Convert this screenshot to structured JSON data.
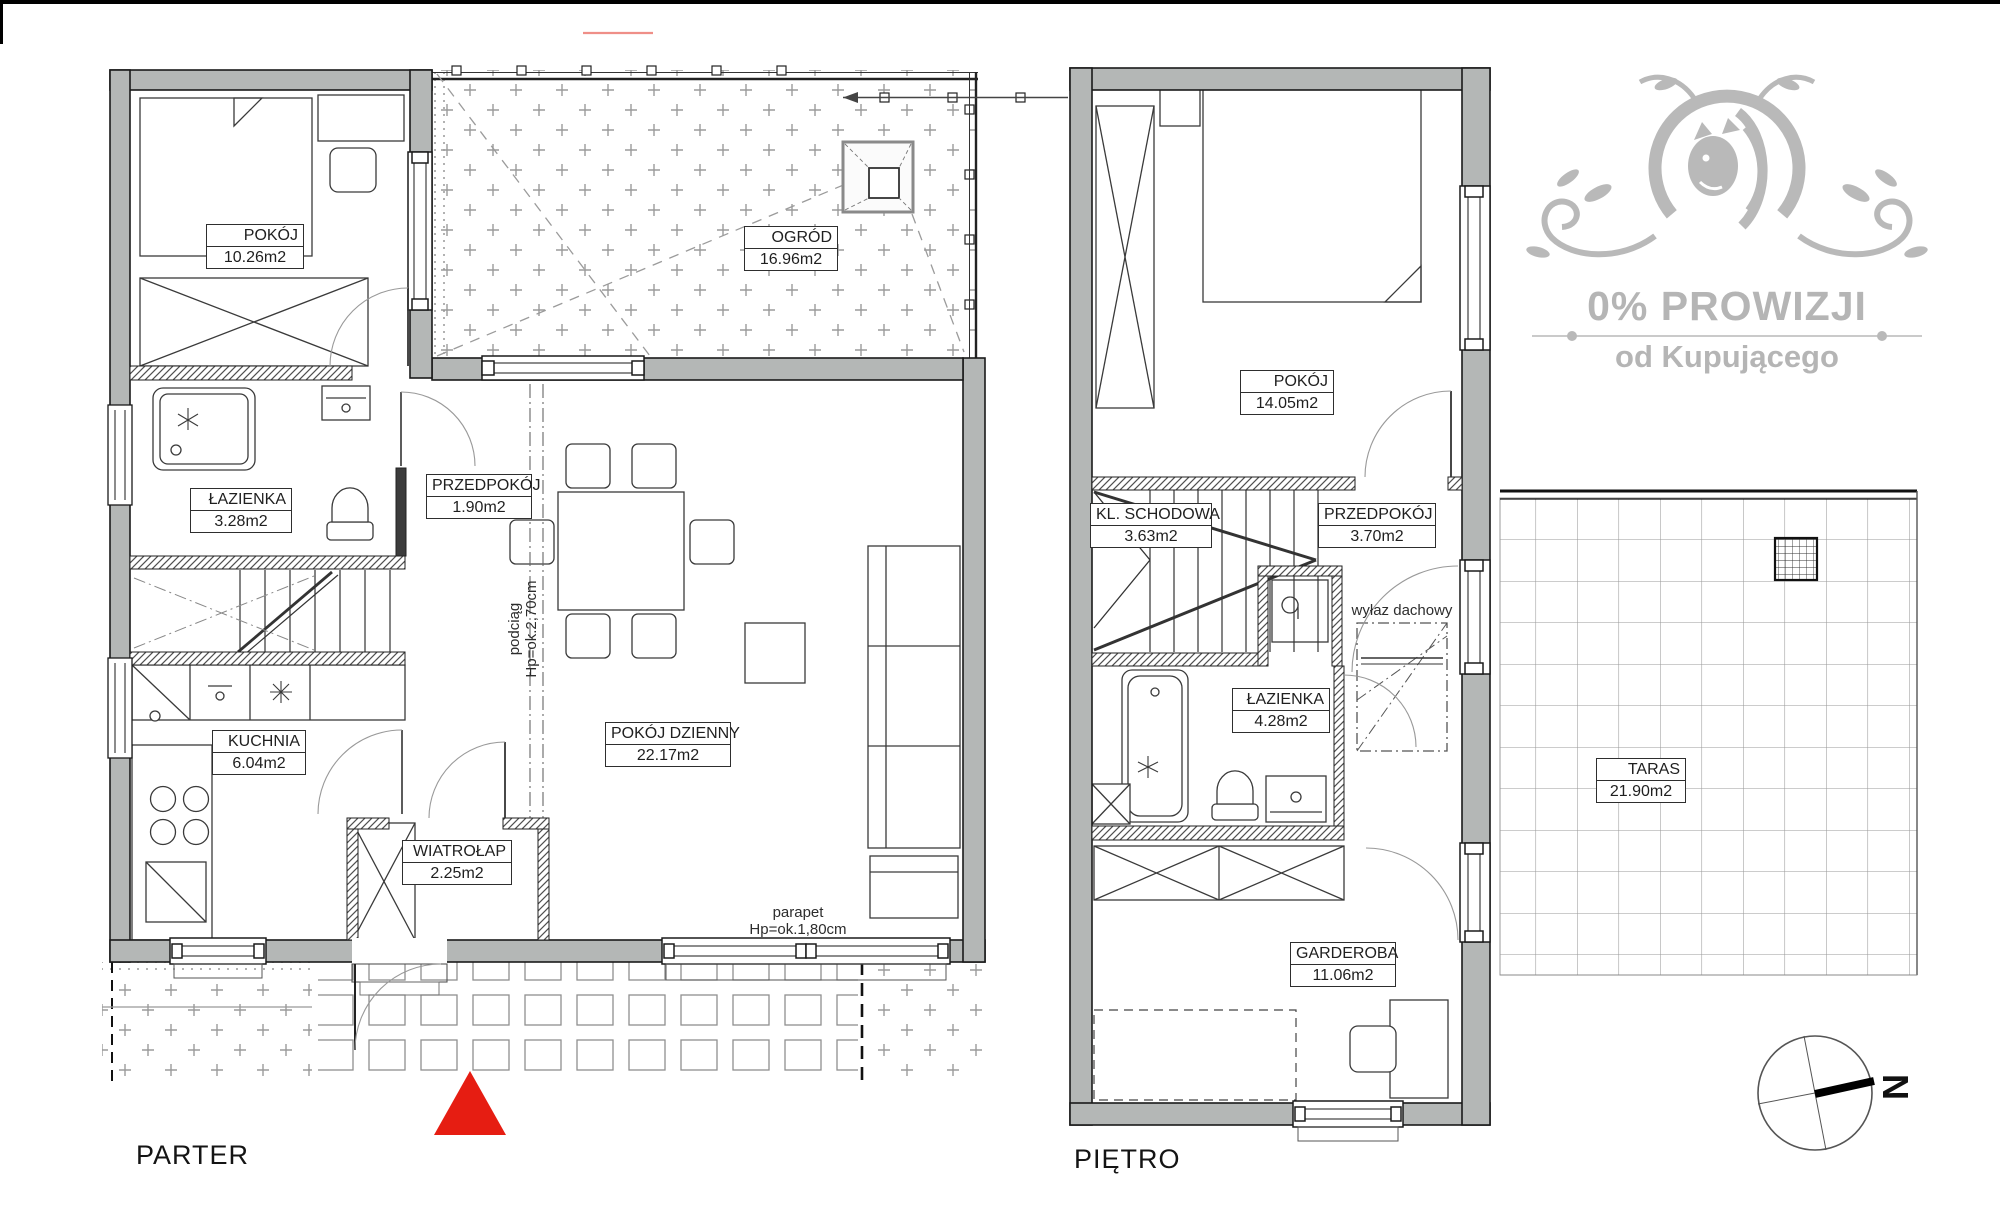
{
  "watermark": {
    "line1": "0% PROWIZJI",
    "line2": "od Kupującego"
  },
  "floors": {
    "parter": {
      "title": "PARTER",
      "rooms": [
        {
          "name": "POKÓJ",
          "area": "10.26m2"
        },
        {
          "name": "OGRÓD",
          "area": "16.96m2"
        },
        {
          "name": "ŁAZIENKA",
          "area": "3.28m2"
        },
        {
          "name": "PRZEDPOKÓJ",
          "area": "1.90m2"
        },
        {
          "name": "KUCHNIA",
          "area": "6.04m2"
        },
        {
          "name": "POKÓJ DZIENNY",
          "area": "22.17m2"
        },
        {
          "name": "WIATROŁAP",
          "area": "2.25m2"
        }
      ],
      "annotations": {
        "beam_line1": "podciąg",
        "beam_line2": "Hp=ok.2,70cm",
        "sill_line1": "parapet",
        "sill_line2": "Hp=ok.1,80cm"
      }
    },
    "pietro": {
      "title": "PIĘTRO",
      "rooms": [
        {
          "name": "POKÓJ",
          "area": "14.05m2"
        },
        {
          "name": "KL. SCHODOWA",
          "area": "3.63m2"
        },
        {
          "name": "PRZEDPOKÓJ",
          "area": "3.70m2"
        },
        {
          "name": "ŁAZIENKA",
          "area": "4.28m2"
        },
        {
          "name": "GARDEROBA",
          "area": "11.06m2"
        },
        {
          "name": "TARAS",
          "area": "21.90m2"
        }
      ],
      "annotations": {
        "roof_hatch": "wyłaz dachowy"
      }
    }
  },
  "compass": {
    "letter": "N"
  },
  "colors": {
    "wall": "#b4b7b6",
    "marker_red": "#e61d12",
    "watermark_gray": "#b9b9b9"
  }
}
